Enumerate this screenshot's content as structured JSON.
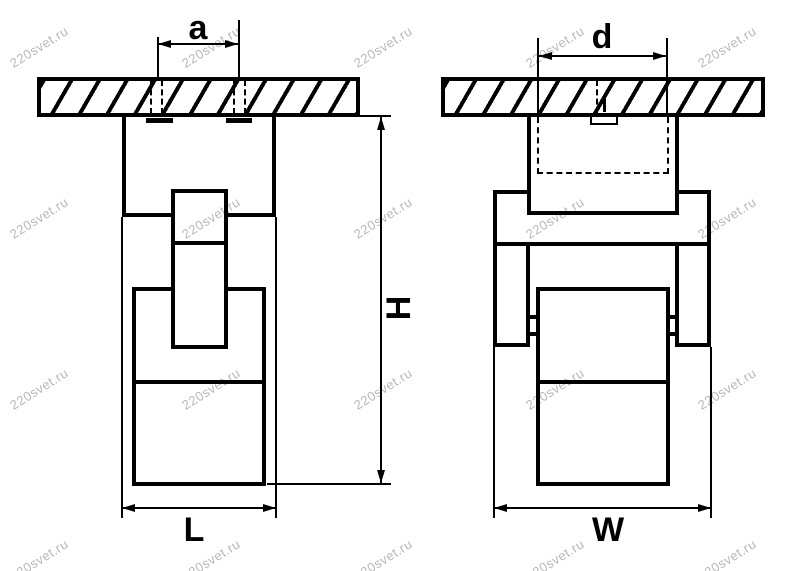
{
  "diagram": {
    "description": "luminaire-dimension-drawing",
    "watermark_text": "220svet.ru",
    "line_color": "#000000",
    "watermark_color": "#b8b8b8",
    "background_color": "#ffffff",
    "views": {
      "front": {
        "dim_mount_spacing": "a",
        "dim_height": "H",
        "dim_length": "L"
      },
      "side": {
        "dim_cutout": "d",
        "dim_width": "W"
      }
    }
  }
}
